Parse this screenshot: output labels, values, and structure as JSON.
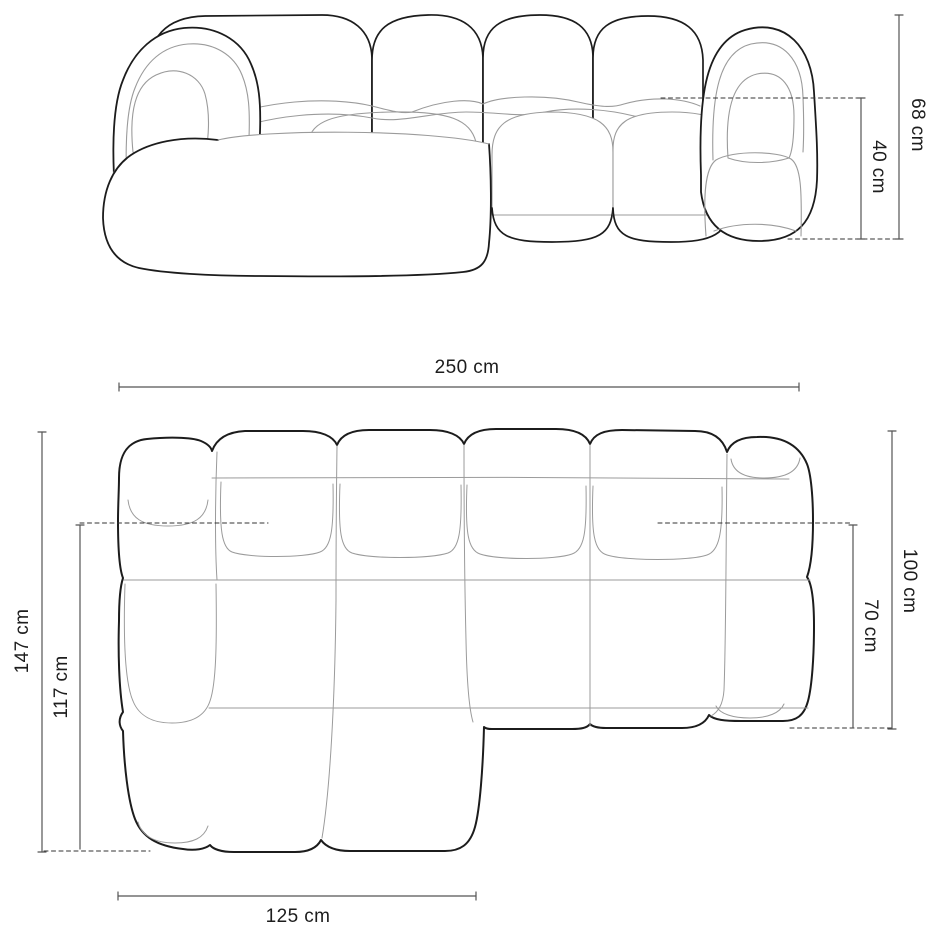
{
  "drawing": {
    "front_view": {
      "dims": {
        "total_height": "68 cm",
        "seat_height": "40 cm"
      }
    },
    "plan_view": {
      "dims": {
        "total_width": "250 cm",
        "total_depth": "147 cm",
        "chaise_depth": "117 cm",
        "body_depth": "100 cm",
        "seat_depth": "70 cm",
        "chaise_width": "125 cm"
      }
    },
    "colors": {
      "outline": "#1c1c1c",
      "seam": "#9b9b9b",
      "dimension_line": "#555555",
      "dash_line": "#333333",
      "background": "#ffffff"
    }
  }
}
